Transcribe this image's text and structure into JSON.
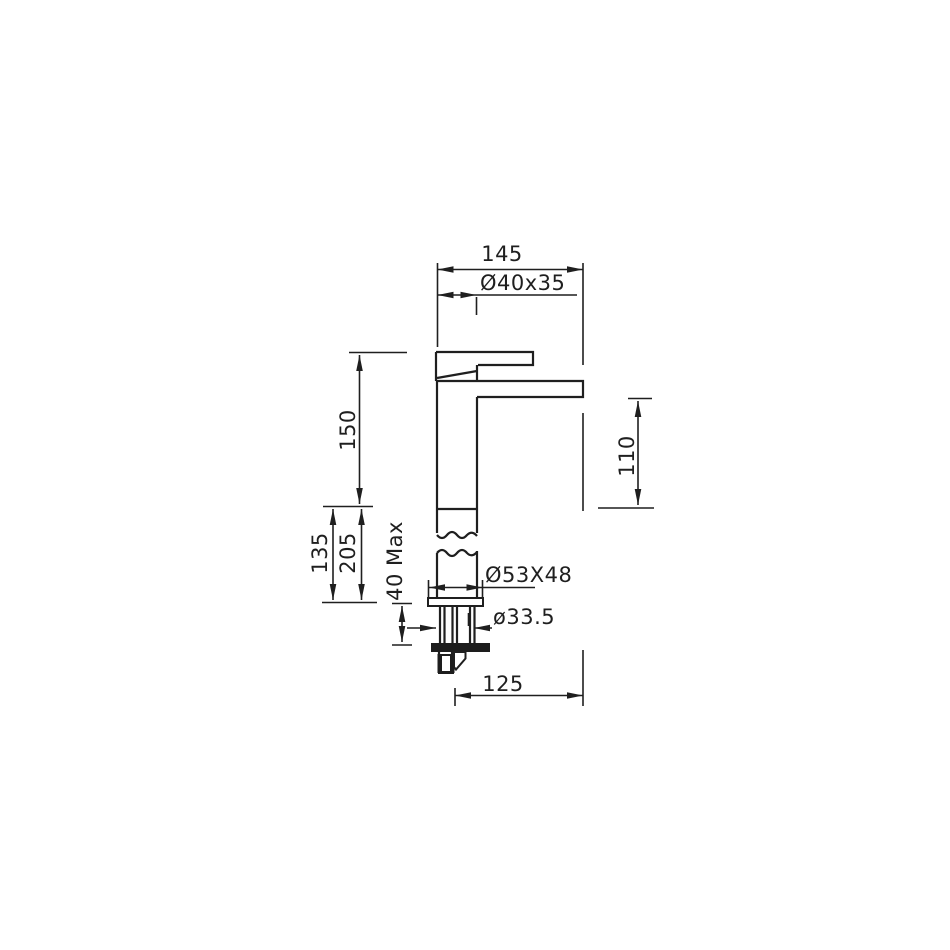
{
  "drawing": {
    "type": "technical-drawing",
    "subject": "single-lever tall basin mixer faucet, side elevation with installation dimensions",
    "units": "mm",
    "colors": {
      "line": "#1f1f1f",
      "background": "#ffffff"
    },
    "dims": {
      "overall_width": "145",
      "handle_body": "Ø40x35",
      "height_deck_to_top": "150",
      "spout_to_deck": "110",
      "height_135": "135",
      "height_205": "205",
      "deck_thickness_max": "40 Max",
      "base_flange": "Ø53X48",
      "shank_diameter": "ø33.5",
      "bottom_reach": "125"
    }
  }
}
